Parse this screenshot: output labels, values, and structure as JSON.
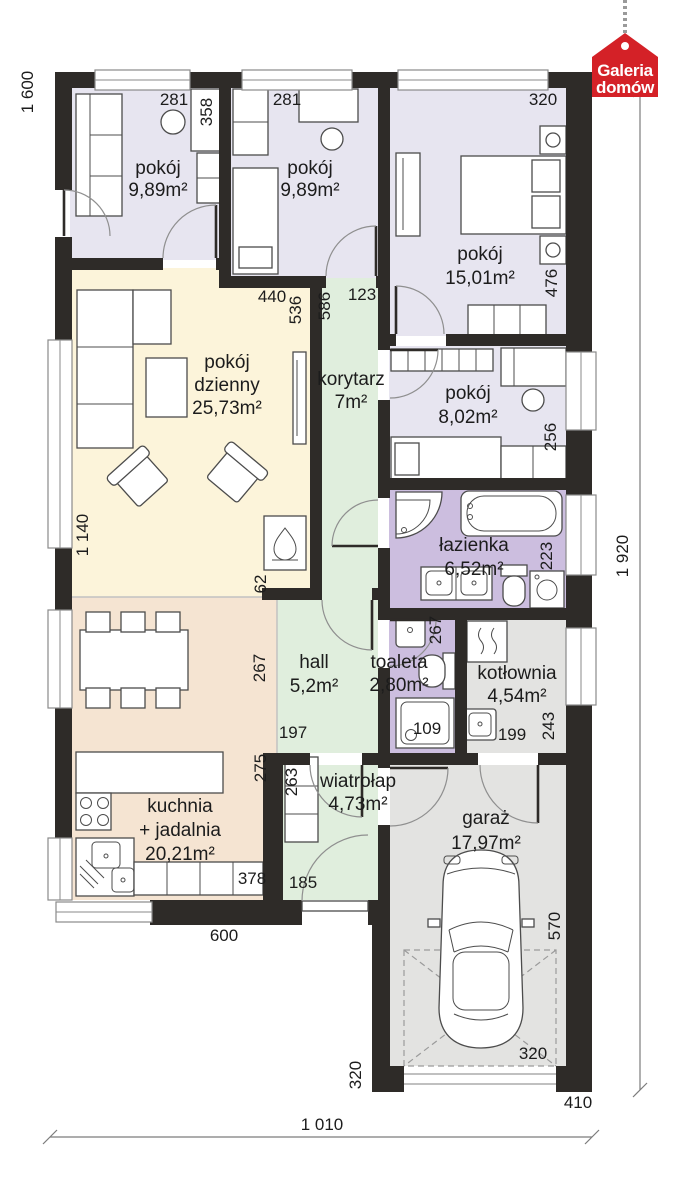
{
  "logo": {
    "line1": "Galeria",
    "line2": "domów"
  },
  "rooms": {
    "pokoj1": {
      "name": "pokój",
      "area": "9,89m²"
    },
    "pokoj2": {
      "name": "pokój",
      "area": "9,89m²"
    },
    "pokoj3": {
      "name": "pokój",
      "area": "15,01m²"
    },
    "dzienny": {
      "name": "pokój",
      "name2": "dzienny",
      "area": "25,73m²"
    },
    "korytarz": {
      "name": "korytarz",
      "area": "7m²"
    },
    "pokoj4": {
      "name": "pokój",
      "area": "8,02m²"
    },
    "lazienka": {
      "name": "łazienka",
      "area": "6,52m²"
    },
    "hall": {
      "name": "hall",
      "area": "5,2m²"
    },
    "toaleta": {
      "name": "toaleta",
      "area": "2,80m²"
    },
    "kotlownia": {
      "name": "kotłownia",
      "area": "4,54m²"
    },
    "kuchnia": {
      "name": "kuchnia",
      "name2": "+ jadalnia",
      "area": "20,21m²"
    },
    "wiatrolap": {
      "name": "wiatrołap",
      "area": "4,73m²"
    },
    "garaz": {
      "name": "garaż",
      "area": "17,97m²"
    }
  },
  "dims": {
    "left_height": "1 600",
    "left_mid": "1 140",
    "right_height": "1 920",
    "bottom_width": "1 010",
    "bottom_kitchen": "600",
    "garage_right_width": "410",
    "p1_w": "281",
    "p1_d": "358",
    "p2_w": "281",
    "p3_w": "320",
    "p3_d": "476",
    "dz_w": "440",
    "dz_d": "536",
    "dz_stub": "62",
    "kor_d": "586",
    "kor_w": "123",
    "p4_d": "256",
    "laz_d": "223",
    "hall_d": "267",
    "hall_w": "197",
    "toal_d": "267",
    "toal_shower": "109",
    "kot_w": "199",
    "kot_d": "243",
    "ku_d": "275",
    "ku_w": "378",
    "wia_d": "263",
    "wia_w": "185",
    "gar_door_h": "320",
    "gar_door_w": "320",
    "gar_d": "570"
  },
  "colors": {
    "wall": "#2e2b28",
    "room_lavender": "#e7e5f0",
    "room_cream": "#fcf4da",
    "room_green": "#e0eedd",
    "room_purple": "#ccbedf",
    "room_tan": "#f5e4d2",
    "room_gray": "#e3e3e1",
    "logo_red": "#d42127"
  }
}
